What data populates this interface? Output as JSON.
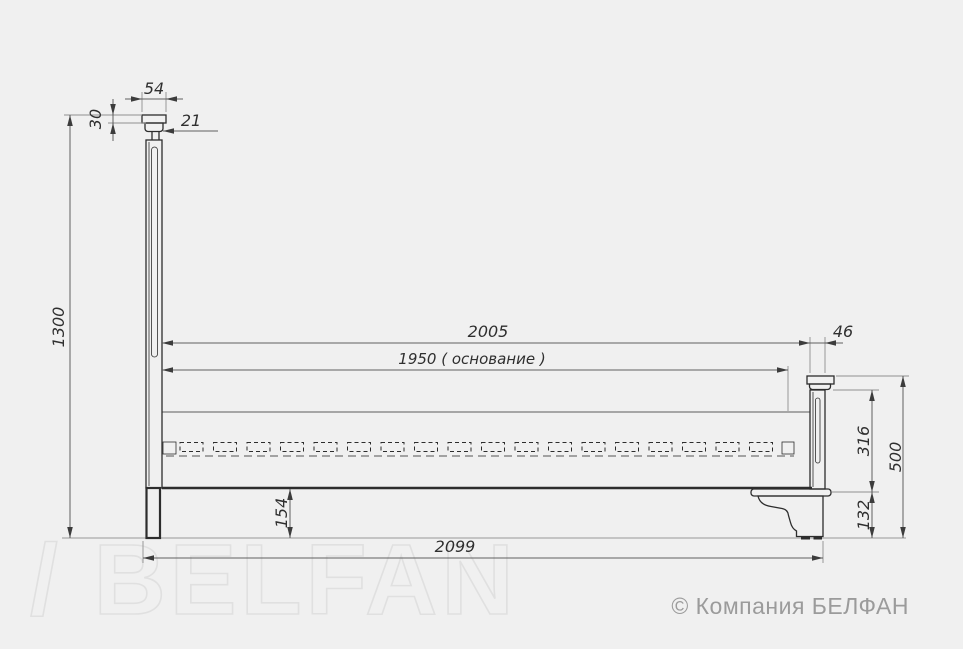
{
  "drawing": {
    "type": "technical-drawing",
    "subject": "bed side elevation with dimensions (mm)",
    "dims": {
      "cap_width": "54",
      "cap_top_height": "30",
      "post_neck": "21",
      "headboard_height": "1300",
      "inner_length": "2005",
      "base_length": "1950 ( основание )",
      "footboard_post_width": "46",
      "footboard_panel_height": "316",
      "footboard_height": "500",
      "foot_height": "132",
      "rail_floor_gap": "154",
      "overall_length": "2099"
    },
    "slat_count": 18
  },
  "watermark": "/ BELFAN",
  "copyright": "© Компания БЕЛФАН",
  "colors": {
    "background": "#f0f0f0",
    "outline": "#2d2d2d",
    "dimension": "#5f5f5f",
    "watermark_stroke": "#e0e0e0",
    "copyright_text": "#9b9b9b"
  }
}
